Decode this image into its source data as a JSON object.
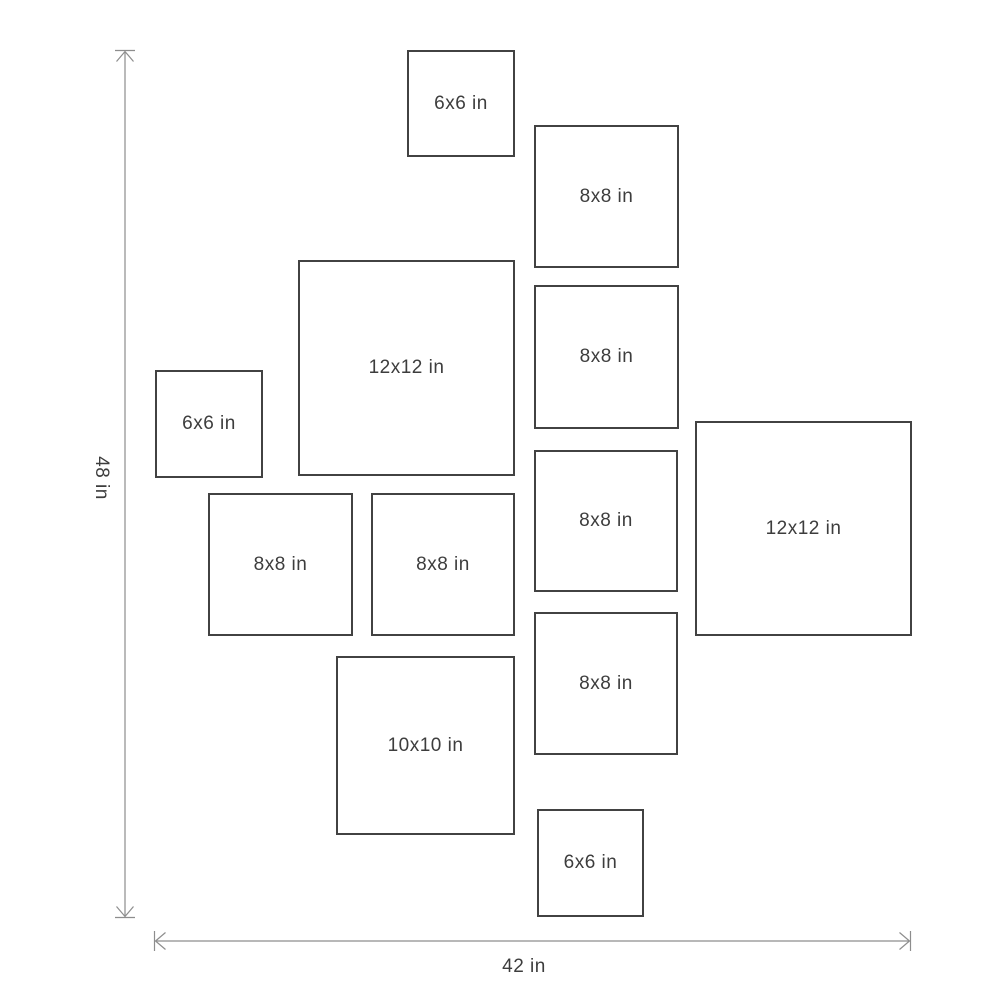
{
  "diagram": {
    "description": "Gallery wall frame size layout diagram",
    "unit": "in",
    "frames": [
      {
        "id": "frame-6x6-top",
        "label": "6x6 in",
        "size_in": "6x6"
      },
      {
        "id": "frame-8x8-right-1",
        "label": "8x8 in",
        "size_in": "8x8"
      },
      {
        "id": "frame-12x12-left",
        "label": "12x12 in",
        "size_in": "12x12"
      },
      {
        "id": "frame-8x8-right-2",
        "label": "8x8 in",
        "size_in": "8x8"
      },
      {
        "id": "frame-6x6-left",
        "label": "6x6 in",
        "size_in": "6x6"
      },
      {
        "id": "frame-12x12-right",
        "label": "12x12 in",
        "size_in": "12x12"
      },
      {
        "id": "frame-8x8-mid-left",
        "label": "8x8 in",
        "size_in": "8x8"
      },
      {
        "id": "frame-8x8-mid",
        "label": "8x8 in",
        "size_in": "8x8"
      },
      {
        "id": "frame-8x8-right-3",
        "label": "8x8 in",
        "size_in": "8x8"
      },
      {
        "id": "frame-8x8-right-4",
        "label": "8x8 in",
        "size_in": "8x8"
      },
      {
        "id": "frame-10x10",
        "label": "10x10 in",
        "size_in": "10x10"
      },
      {
        "id": "frame-6x6-bottom",
        "label": "6x6 in",
        "size_in": "6x6"
      }
    ],
    "dimensions": {
      "height_label": "48 in",
      "width_label": "42 in"
    },
    "colors": {
      "background": "#ffffff",
      "frame_border": "#424242",
      "label_text": "#3d3d3d",
      "arrow": "#8d8d8d"
    }
  }
}
